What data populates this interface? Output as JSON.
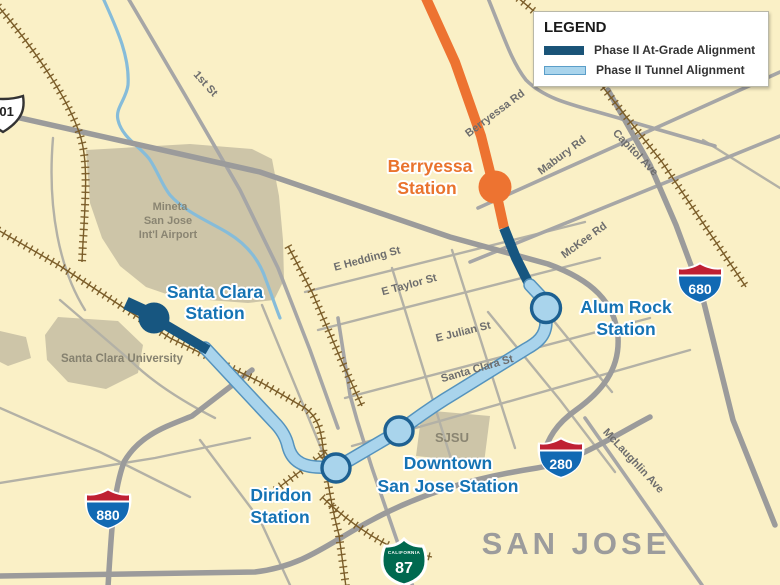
{
  "legend": {
    "title": "LEGEND",
    "items": [
      {
        "label": "Phase II At-Grade Alignment",
        "color": "#1A5478"
      },
      {
        "label": "Phase II Tunnel Alignment",
        "color": "#A9D4EC"
      }
    ]
  },
  "stations": {
    "berryessa": {
      "line1": "Berryessa",
      "line2": "Station",
      "color": "#E9732D",
      "type": "existing-terminus"
    },
    "alum_rock": {
      "line1": "Alum Rock",
      "line2": "Station",
      "type": "tunnel"
    },
    "downtown": {
      "line1": "Downtown",
      "line2": "San Jose Station",
      "type": "tunnel"
    },
    "diridon": {
      "line1": "Diridon",
      "line2": "Station",
      "type": "tunnel"
    },
    "santa_clara": {
      "line1": "Santa Clara",
      "line2": "Station",
      "type": "at-grade"
    }
  },
  "roads": {
    "first_st": "1st St",
    "berryessa_rd": "Berryessa Rd",
    "mabury_rd": "Mabury Rd",
    "capitol_ave": "Capitol Ave",
    "mckee_rd": "McKee Rd",
    "hedding": "E Hedding St",
    "taylor": "E Taylor St",
    "julian": "E Julian St",
    "santa_clara_st": "Santa Clara St",
    "mclaughlin": "McLaughlin Ave"
  },
  "areas": {
    "airport_line1": "Mineta",
    "airport_line2": "San Jose",
    "airport_line3": "Int'l Airport",
    "university": "Santa Clara University",
    "sjsu": "SJSU",
    "city": "SAN JOSE"
  },
  "shields": {
    "us101": "101",
    "i680": "680",
    "i280": "280",
    "i880": "880",
    "ca87": "87",
    "ca_text": "CALIFORNIA"
  },
  "colors": {
    "background": "#FAF0C6",
    "at_grade": "#175680",
    "tunnel_fill": "#A9D4EC",
    "tunnel_edge": "#5593bd",
    "existing_orange": "#ED7331",
    "station_text_blue": "#1573B4",
    "road_gray": "#9b9b9b",
    "railroad_brown": "#7a5c28",
    "land_polygon": "#CDC5A8",
    "river_blue": "#86BCD9"
  }
}
